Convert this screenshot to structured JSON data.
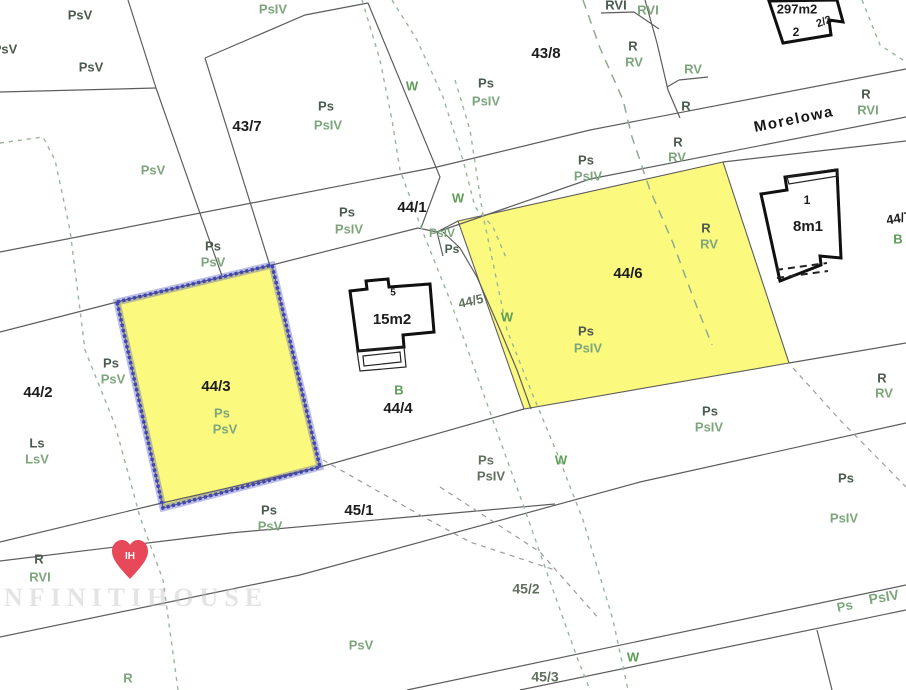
{
  "map": {
    "street": "Morelowa",
    "watermark": "INFINITIHOUSE",
    "highlighted_parcels": [
      "44/3",
      "44/6"
    ],
    "pin": {
      "text": "IH"
    },
    "colors": {
      "parcel_highlight": "#FBF97E",
      "selection_border": "#3F45B8",
      "boundary_line": "#5D5D5D",
      "landuse_primary": "#4B5A4E",
      "landuse_secondary": "#7DA67D",
      "water_symbol_green": "#5D9E56",
      "pin_red": "#E8495A",
      "label_black": "#1C1C1C",
      "label_gray": "#62705F"
    },
    "labels": [
      {
        "t": "PsV",
        "x": 80,
        "y": 16,
        "c": "lu1",
        "s": 13
      },
      {
        "t": "PsV",
        "x": 5,
        "y": 50,
        "c": "lu1",
        "s": 13
      },
      {
        "t": "PsV",
        "x": 91,
        "y": 68,
        "c": "lu1",
        "s": 13
      },
      {
        "t": "PsIV",
        "x": 273,
        "y": 10,
        "c": "lu2",
        "s": 13
      },
      {
        "t": "Ps",
        "x": 326,
        "y": 107,
        "c": "lu1",
        "s": 13
      },
      {
        "t": "PsIV",
        "x": 328,
        "y": 126,
        "c": "lu2",
        "s": 13
      },
      {
        "t": "43/7",
        "x": 247,
        "y": 127,
        "c": "num",
        "s": 15
      },
      {
        "t": "PsV",
        "x": 153,
        "y": 171,
        "c": "lu2",
        "s": 13
      },
      {
        "t": "W",
        "x": 412,
        "y": 87,
        "c": "wb",
        "s": 13
      },
      {
        "t": "43/8",
        "x": 546,
        "y": 54,
        "c": "num",
        "s": 15
      },
      {
        "t": "Ps",
        "x": 486,
        "y": 84,
        "c": "lu1",
        "s": 13
      },
      {
        "t": "PsIV",
        "x": 486,
        "y": 102,
        "c": "lu2",
        "s": 13
      },
      {
        "t": "RVI",
        "x": 616,
        "y": 6,
        "c": "lu1",
        "s": 13
      },
      {
        "t": "RVI",
        "x": 648,
        "y": 11,
        "c": "lu2",
        "s": 13
      },
      {
        "t": "R",
        "x": 633,
        "y": 47,
        "c": "lu1",
        "s": 13
      },
      {
        "t": "RV",
        "x": 634,
        "y": 63,
        "c": "lu2",
        "s": 13
      },
      {
        "t": "RV",
        "x": 693,
        "y": 70,
        "c": "lu2",
        "s": 13
      },
      {
        "t": "R",
        "x": 686,
        "y": 107,
        "c": "lu1",
        "s": 13
      },
      {
        "t": "297m2",
        "x": 797,
        "y": 10,
        "c": "num",
        "s": 13
      },
      {
        "t": "2/2",
        "x": 824,
        "y": 22,
        "c": "num",
        "s": 11,
        "r": -20
      },
      {
        "t": "2",
        "x": 796,
        "y": 33,
        "c": "num",
        "s": 12
      },
      {
        "t": "Morelowa",
        "x": 794,
        "y": 120,
        "c": "street",
        "s": 15,
        "r": -11.5
      },
      {
        "t": "R",
        "x": 866,
        "y": 95,
        "c": "lu1",
        "s": 13
      },
      {
        "t": "RVI",
        "x": 868,
        "y": 111,
        "c": "lu2",
        "s": 13
      },
      {
        "t": "Ps",
        "x": 347,
        "y": 213,
        "c": "lu1",
        "s": 13
      },
      {
        "t": "PsIV",
        "x": 349,
        "y": 230,
        "c": "lu2",
        "s": 13
      },
      {
        "t": "44/1",
        "x": 412,
        "y": 208,
        "c": "num",
        "s": 15
      },
      {
        "t": "W",
        "x": 458,
        "y": 199,
        "c": "wb",
        "s": 13
      },
      {
        "t": "PsIV",
        "x": 442,
        "y": 234,
        "c": "lu2",
        "s": 12
      },
      {
        "t": "Ps",
        "x": 452,
        "y": 250,
        "c": "lu1",
        "s": 12
      },
      {
        "t": "Ps",
        "x": 586,
        "y": 161,
        "c": "lu1",
        "s": 13
      },
      {
        "t": "PsIV",
        "x": 588,
        "y": 177,
        "c": "lu2",
        "s": 13
      },
      {
        "t": "R",
        "x": 678,
        "y": 143,
        "c": "lu1",
        "s": 13
      },
      {
        "t": "RV",
        "x": 677,
        "y": 158,
        "c": "lu2",
        "s": 13
      },
      {
        "t": "Ps",
        "x": 213,
        "y": 247,
        "c": "lu1",
        "s": 13
      },
      {
        "t": "PsV",
        "x": 213,
        "y": 263,
        "c": "lu2",
        "s": 13
      },
      {
        "t": "44/6",
        "x": 628,
        "y": 274,
        "c": "num",
        "s": 15
      },
      {
        "t": "R",
        "x": 706,
        "y": 229,
        "c": "lu1",
        "s": 13
      },
      {
        "t": "RV",
        "x": 709,
        "y": 245,
        "c": "lu2",
        "s": 13
      },
      {
        "t": "Ps",
        "x": 586,
        "y": 332,
        "c": "lu1",
        "s": 13
      },
      {
        "t": "PsIV",
        "x": 588,
        "y": 349,
        "c": "lu2",
        "s": 13
      },
      {
        "t": "W",
        "x": 507,
        "y": 318,
        "c": "wb",
        "s": 13
      },
      {
        "t": "44/5",
        "x": 471,
        "y": 302,
        "c": "numg",
        "s": 13,
        "r": -13
      },
      {
        "t": "1",
        "x": 807,
        "y": 201,
        "c": "num",
        "s": 12
      },
      {
        "t": "8m1",
        "x": 808,
        "y": 227,
        "c": "num",
        "s": 15
      },
      {
        "t": "44/7",
        "x": 899,
        "y": 219,
        "c": "num",
        "s": 13,
        "r": -10
      },
      {
        "t": "B",
        "x": 898,
        "y": 240,
        "c": "wb",
        "s": 13
      },
      {
        "t": "R",
        "x": 882,
        "y": 379,
        "c": "lu1",
        "s": 13
      },
      {
        "t": "RV",
        "x": 884,
        "y": 394,
        "c": "lu2",
        "s": 13
      },
      {
        "t": "15m2",
        "x": 392,
        "y": 320,
        "c": "num",
        "s": 15
      },
      {
        "t": "5",
        "x": 393,
        "y": 293,
        "c": "num",
        "s": 10
      },
      {
        "t": "B",
        "x": 399,
        "y": 391,
        "c": "wb",
        "s": 13
      },
      {
        "t": "44/4",
        "x": 398,
        "y": 409,
        "c": "num",
        "s": 15
      },
      {
        "t": "Ps",
        "x": 111,
        "y": 364,
        "c": "lu1",
        "s": 13
      },
      {
        "t": "PsV",
        "x": 113,
        "y": 380,
        "c": "lu2",
        "s": 13
      },
      {
        "t": "44/2",
        "x": 38,
        "y": 393,
        "c": "num",
        "s": 15
      },
      {
        "t": "Ls",
        "x": 37,
        "y": 444,
        "c": "lu1",
        "s": 13
      },
      {
        "t": "LsV",
        "x": 37,
        "y": 460,
        "c": "lu2",
        "s": 13
      },
      {
        "t": "44/3",
        "x": 216,
        "y": 387,
        "c": "num",
        "s": 15
      },
      {
        "t": "Ps",
        "x": 222,
        "y": 414,
        "c": "lu2",
        "s": 13
      },
      {
        "t": "PsV",
        "x": 225,
        "y": 430,
        "c": "lu2",
        "s": 13
      },
      {
        "t": "Ps",
        "x": 269,
        "y": 511,
        "c": "lu1",
        "s": 13
      },
      {
        "t": "PsV",
        "x": 270,
        "y": 527,
        "c": "lu2",
        "s": 13
      },
      {
        "t": "45/1",
        "x": 359,
        "y": 511,
        "c": "num",
        "s": 15
      },
      {
        "t": "Ps",
        "x": 486,
        "y": 461,
        "c": "numg",
        "s": 13
      },
      {
        "t": "PsIV",
        "x": 491,
        "y": 477,
        "c": "numg",
        "s": 13
      },
      {
        "t": "W",
        "x": 561,
        "y": 461,
        "c": "wb",
        "s": 13
      },
      {
        "t": "Ps",
        "x": 710,
        "y": 412,
        "c": "lu1",
        "s": 13
      },
      {
        "t": "PsIV",
        "x": 709,
        "y": 428,
        "c": "lu2",
        "s": 13
      },
      {
        "t": "Ps",
        "x": 846,
        "y": 479,
        "c": "lu1",
        "s": 13
      },
      {
        "t": "PsIV",
        "x": 844,
        "y": 519,
        "c": "lu2",
        "s": 13
      },
      {
        "t": "45/2",
        "x": 526,
        "y": 590,
        "c": "numg",
        "s": 14
      },
      {
        "t": "W",
        "x": 633,
        "y": 658,
        "c": "wb",
        "s": 13
      },
      {
        "t": "45/3",
        "x": 545,
        "y": 678,
        "c": "numg",
        "s": 14
      },
      {
        "t": "PsV",
        "x": 361,
        "y": 646,
        "c": "lu2",
        "s": 13
      },
      {
        "t": "R",
        "x": 128,
        "y": 679,
        "c": "lu2",
        "s": 13
      },
      {
        "t": "R",
        "x": 39,
        "y": 560,
        "c": "lu1",
        "s": 13
      },
      {
        "t": "RVI",
        "x": 40,
        "y": 578,
        "c": "lu2",
        "s": 13
      },
      {
        "t": "Ps",
        "x": 845,
        "y": 607,
        "c": "lu2",
        "s": 13,
        "r": -12
      },
      {
        "t": "PsIV",
        "x": 884,
        "y": 598,
        "c": "lu2",
        "s": 14,
        "r": -10
      }
    ]
  }
}
